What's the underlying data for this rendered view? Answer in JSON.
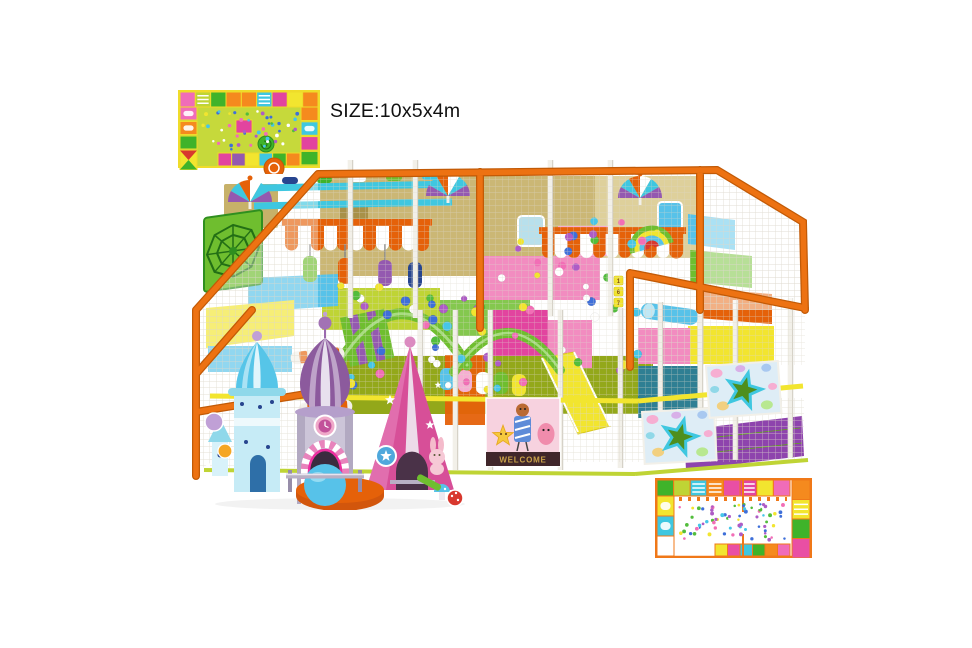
{
  "image": {
    "type": "3d-product-render",
    "subject": "indoor soft play playground equipment",
    "background": "#ffffff"
  },
  "size_label": "SIZE:10x5x4m",
  "welcome_sign": "WELCOME",
  "number_stickers": [
    "1",
    "6",
    "7"
  ],
  "palette": {
    "frame": "#ED7212",
    "frameDark": "#C25A06",
    "post": "#F2F0E9",
    "postShade": "#CBC6BA",
    "net": "#DDD8CC",
    "tan": "#C7B169",
    "tanL": "#D8C88A",
    "cyan": "#3FC7E0",
    "sky": "#57C2E9",
    "skyPale": "#BFE8F5",
    "yellow": "#F2E52F",
    "ylgreen": "#BFD435",
    "olive": "#93A81A",
    "grass": "#6FBE2F",
    "green": "#3FB32A",
    "starGreen": "#4E8F1E",
    "pink": "#F28CC0",
    "pinkL": "#F6AED2",
    "magenta": "#E2449F",
    "hotpink": "#ED2FA0",
    "purple": "#9459B0",
    "dome": "#8C5A9D",
    "cgray": "#CCC5D8",
    "cgrayD": "#978DA9",
    "blueroof": "#56C5E8",
    "bluepale": "#C6EBF6",
    "cone": "#D74F98",
    "coneL": "#E883BC",
    "orange": "#F58A1E",
    "dporange": "#E56109",
    "red": "#D8382E",
    "navy": "#27458F",
    "teal": "#2F7F93",
    "lav": "#C0A0D6",
    "signBg": "#F7D2DF",
    "signDark": "#40262A",
    "gold": "#C9A24A"
  },
  "ball_colors": [
    "#46C6E8",
    "#F26EB6",
    "#FFFFFF",
    "#52BD3C",
    "#AE5CC6",
    "#3E6FD9",
    "#F2E52F"
  ],
  "balls": {
    "count_main": 58,
    "count_upper": 16
  },
  "top_plan": {
    "field": "#C6D93B",
    "border": "#EFDC2A",
    "top_cells": [
      "#F06CB8",
      "L:#BFD435",
      "#3FB32A",
      "#F58A1E",
      "#F58A1E",
      "L:#3FC7E0",
      "#E2449F",
      "#F2E52F",
      "#F58A1E"
    ],
    "left_cells": [
      "R:#F06CB8",
      "R:#F58A1E",
      "#3FB32A",
      "T:#F2E52F"
    ],
    "right_cells": [
      "#F58A1E",
      "R:#3FC7E0",
      "#E2449F",
      "#3FB32A"
    ],
    "bottom_cells": [
      "#E2449F",
      "#9459B0",
      "#F2E52F",
      "#3FC7E0",
      "#3FB32A",
      "#F58A1E"
    ],
    "confetti": 46
  },
  "bottom_plan": {
    "bg": "#FFFFFF",
    "border": "#F07818",
    "top_cells": [
      "#3FB32A",
      "#BFD435",
      "L:#3FC7E0",
      "L:#F58A1E",
      "#E94FA4",
      "L:#E2449F",
      "#F2E52F",
      "#F06CB8"
    ],
    "left_cells": [
      "R:#F2E52F",
      "R:#3FC7E0",
      "#FFFFFF"
    ],
    "right_cells": [
      "#F58A1E",
      "L:#F2E52F",
      "#3FB32A",
      "#E94FA4"
    ],
    "bottom_cells": [
      "#F2E52F",
      "#E94FA4",
      "#3FC7E0",
      "#3FB32A",
      "#F58A1E",
      "#F06CB8"
    ],
    "confetti": 85
  },
  "decor": {
    "umbrellas": 3,
    "striped_awnings": 2,
    "star_panels": 2,
    "castle_towers": 3
  }
}
